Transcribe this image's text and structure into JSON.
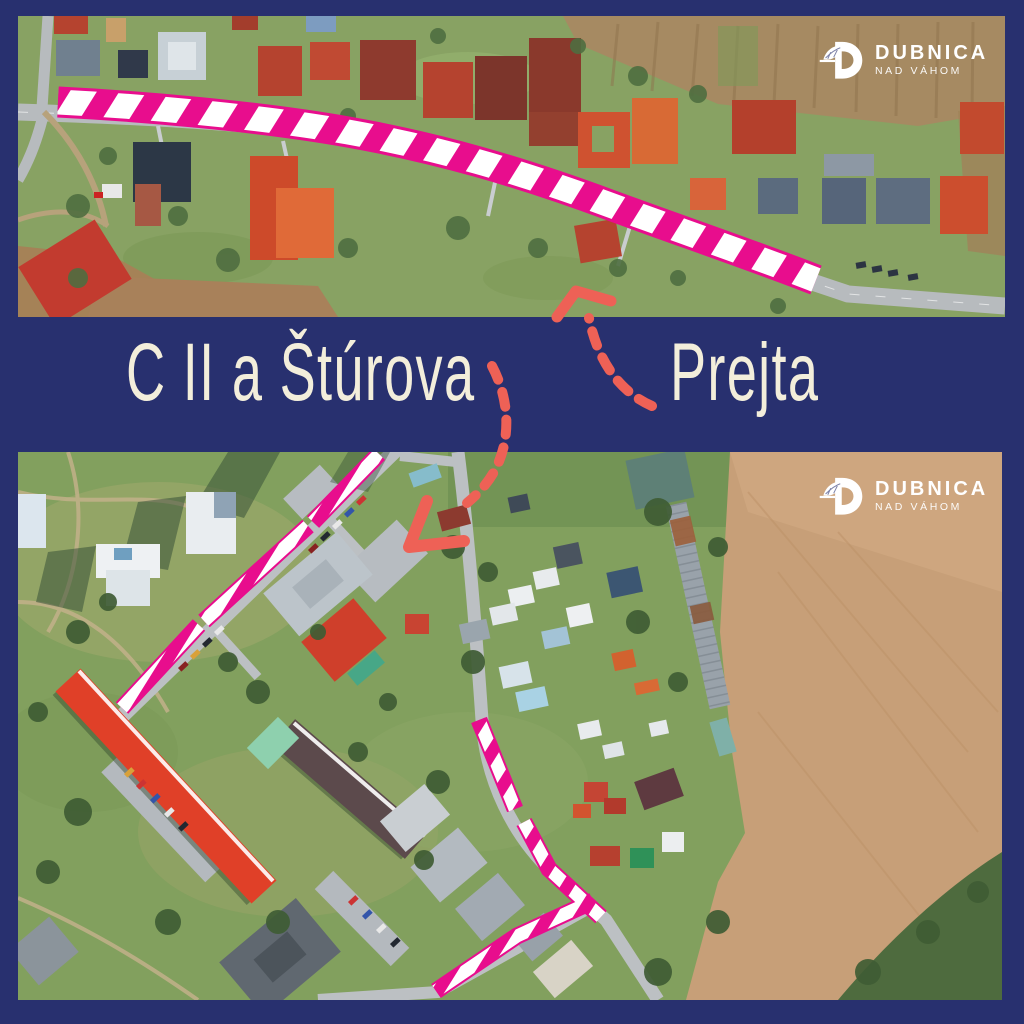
{
  "brand": {
    "title": "DUBNICA",
    "subtitle": "NAD VÁHOM"
  },
  "labels": {
    "left": "C II a Štúrova",
    "right": "Prejta"
  },
  "colors": {
    "background": "#28306f",
    "route_highlight": "#e80d8d",
    "route_stripe": "#ffffff",
    "arrow": "#ee6156",
    "label_text": "#f3eedb",
    "logo": "#ffffff"
  }
}
